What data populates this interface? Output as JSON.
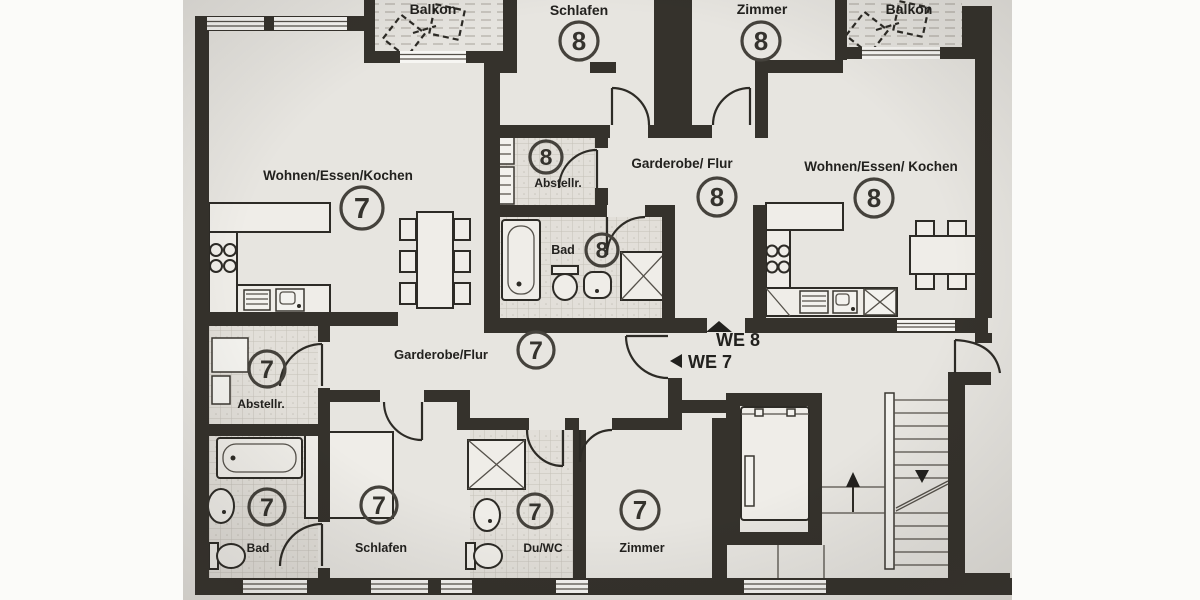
{
  "plan": {
    "type": "apartment-floor-plan",
    "language": "de",
    "colors": {
      "paper": "#e7e5e0",
      "wall": "#35322c",
      "ink": "#2d2b26"
    },
    "units": [
      {
        "id": "7",
        "entry_label": "WE 7"
      },
      {
        "id": "8",
        "entry_label": "WE 8"
      }
    ],
    "labels": {
      "balkon_left": "Balkon",
      "balkon_right": "Balkon",
      "schlafen_8": "Schlafen",
      "zimmer_8": "Zimmer",
      "wohnen_7": "Wohnen/Essen/Kochen",
      "wohnen_8": "Wohnen/Essen/ Kochen",
      "garderobe_8": "Garderobe/ Flur",
      "garderobe_7": "Garderobe/Flur",
      "abstell_8": "Abstellr.",
      "abstell_7": "Abstellr.",
      "bad_8": "Bad",
      "bad_7": "Bad",
      "schlafen_7": "Schlafen",
      "du_wc_7": "Du/WC",
      "zimmer_7": "Zimmer",
      "we_7": "WE 7",
      "we_8": "WE 8",
      "num_7": "7",
      "num_8": "8"
    }
  }
}
